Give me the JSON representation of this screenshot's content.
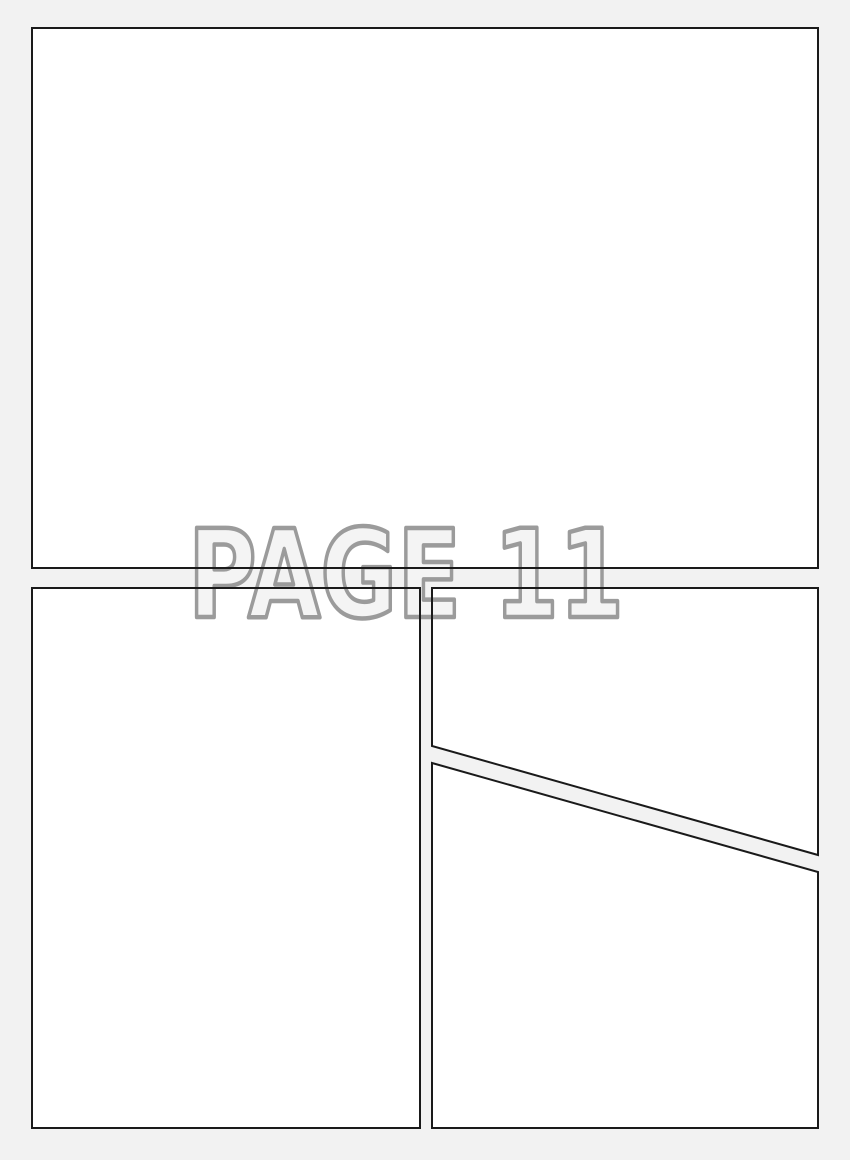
{
  "page": {
    "title": "PAGE 11"
  },
  "colors": {
    "background": "#f2f2f2",
    "panel_fill": "#ffffff",
    "panel_border": "#1a1a1a",
    "title_outline": "#9b9b9b",
    "title_fill": "#f4f4f4"
  }
}
